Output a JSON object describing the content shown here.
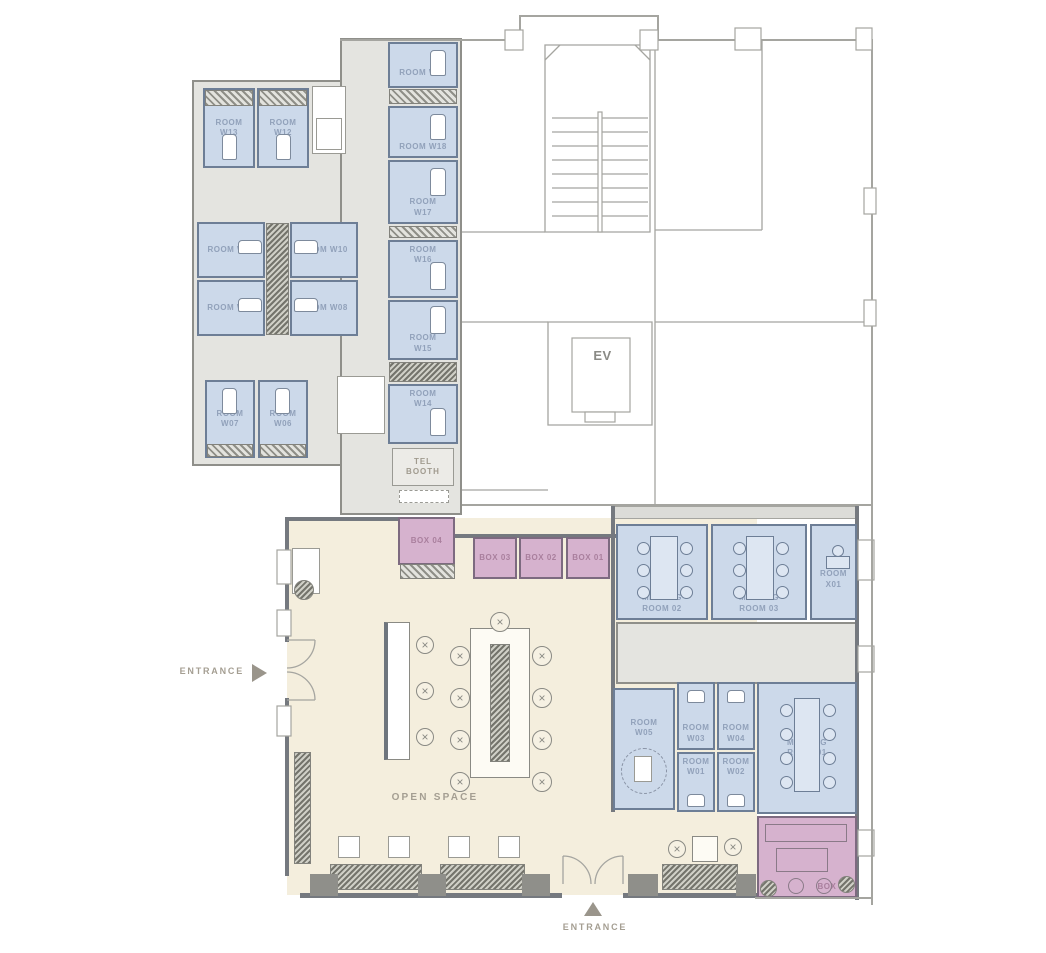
{
  "labels": {
    "open_space": "OPEN SPACE",
    "entrance_left": "ENTRANCE",
    "entrance_bottom": "ENTRANCE",
    "elevator": "EV",
    "tel_booth": "TEL BOOTH"
  },
  "rooms": {
    "w13": "ROOM W13",
    "w12": "ROOM W12",
    "w11": "ROOM W11",
    "w10": "ROOM W10",
    "w09": "ROOM W09",
    "w08": "ROOM W08",
    "w07": "ROOM W07",
    "w06": "ROOM W06",
    "w19": "ROOM W19",
    "w18": "ROOM W18",
    "w17": "ROOM W17",
    "w16": "ROOM W16",
    "w15": "ROOM W15",
    "w14": "ROOM W14",
    "w05": "ROOM W05",
    "w04": "ROOM W04",
    "w03": "ROOM W03",
    "w02": "ROOM W02",
    "w01": "ROOM W01",
    "x01": "ROOM X01",
    "meeting01": "MEETING ROOM 01",
    "meeting02": "MEETING ROOM 02",
    "meeting03": "MEETING ROOM 03"
  },
  "boxes": {
    "b01": "BOX 01",
    "b02": "BOX 02",
    "b03": "BOX 03",
    "b04": "BOX 04",
    "b05": "BOX 05"
  },
  "colors": {
    "room_fill": "#ccd9ea",
    "room_border": "#6d7e96",
    "room_label": "#91a1ba",
    "box_fill": "#d6b2ce",
    "box_border": "#7d6a80",
    "box_label": "#a97f9d",
    "open_space_fill": "#f4eedd",
    "corridor_fill": "#e4e4e0",
    "wall_dark": "#75797f",
    "wall_light": "#a5a5a0",
    "gray_label": "#a49e92"
  }
}
